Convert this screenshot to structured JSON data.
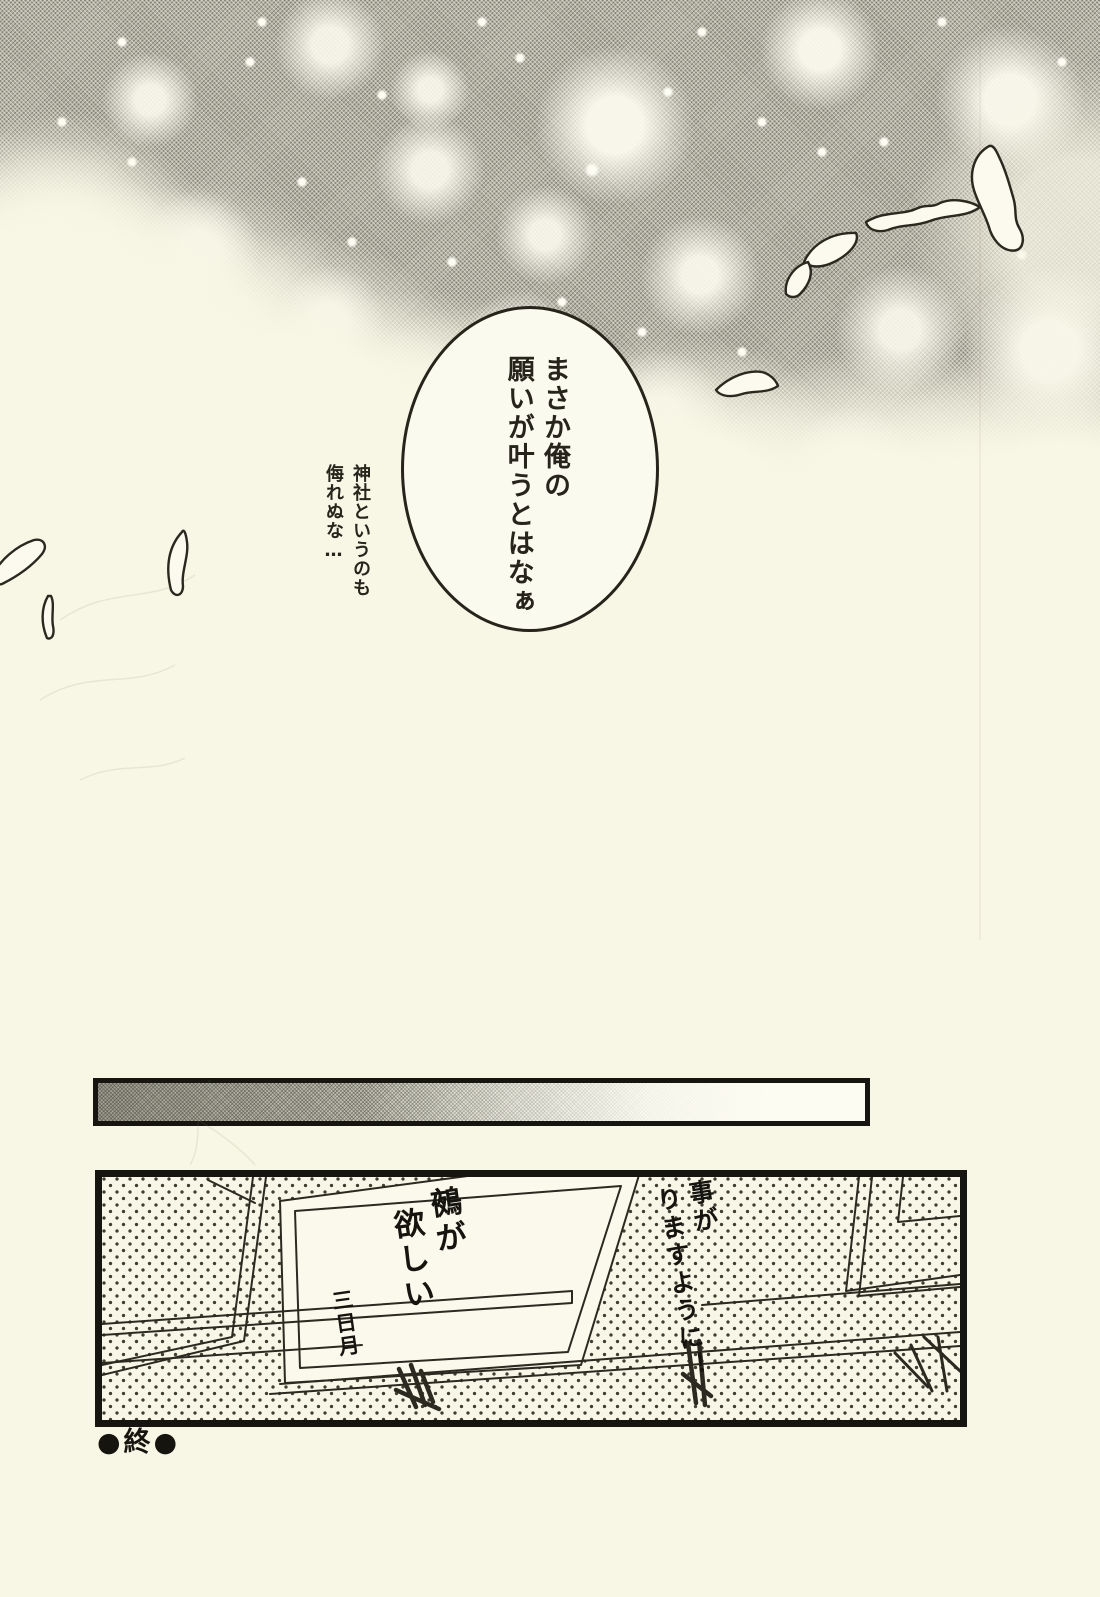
{
  "page": {
    "balloon": {
      "line1": "まさか俺の",
      "line2": "願いが叶うとはなぁ"
    },
    "aside": {
      "line1": "神社というのも",
      "line2": "侮れぬな…"
    },
    "panel": {
      "ema_main": {
        "line1": "鵺が",
        "line2": "欲しい",
        "signature": "三日月"
      },
      "ema_right": {
        "line1": "い事が",
        "line2": "りますように！"
      }
    },
    "end_mark": "●終●",
    "colors": {
      "paper": "#f8f6e5",
      "ink": "#23211a",
      "tone_gray": "#b3b1a4"
    },
    "icons": {
      "feather": "white feather outline"
    }
  }
}
